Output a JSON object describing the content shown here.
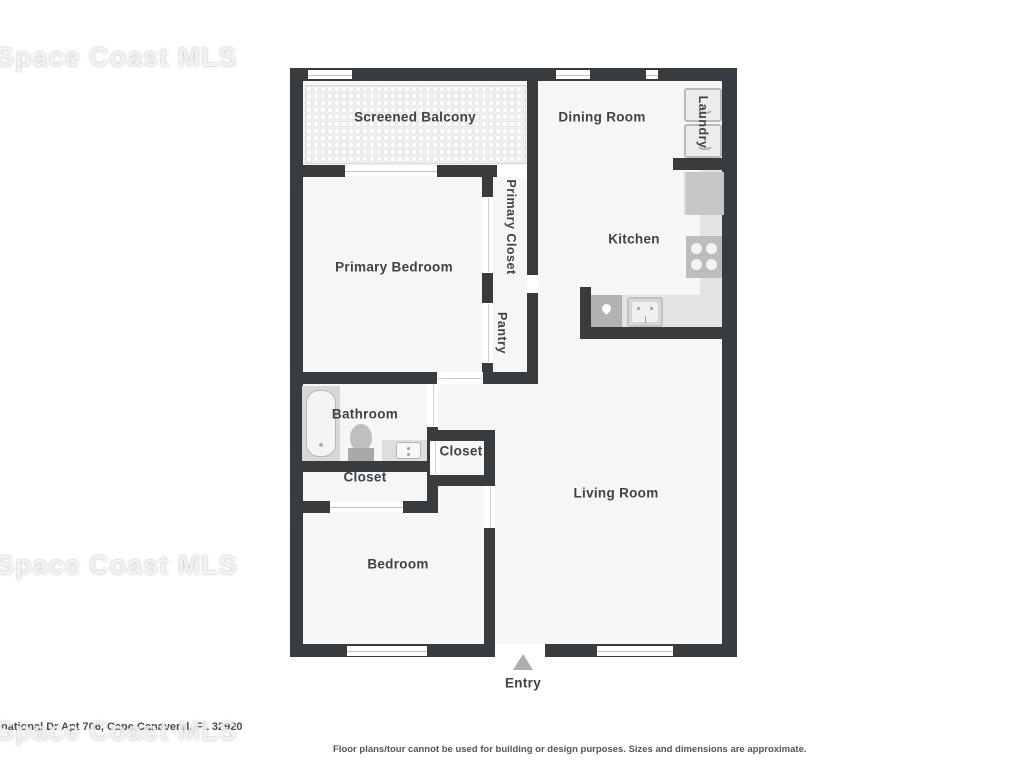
{
  "watermark": {
    "text": "Space Coast MLS"
  },
  "footer": {
    "address": "national Dr Apt 706, Cape Canaveral, FL 32920",
    "disclaimer": "Floor plans/tour cannot be used for building or design purposes. Sizes and dimensions are approximate."
  },
  "floor_plan": {
    "labels": {
      "screened_balcony": "Screened Balcony",
      "dining_room": "Dining Room",
      "laundry": "Laundry",
      "primary_closet": "Primary Closet",
      "primary_bedroom": "Primary Bedroom",
      "kitchen": "Kitchen",
      "pantry": "Pantry",
      "bathroom": "Bathroom",
      "closet_hall": "Closet",
      "closet_bedroom": "Closet",
      "living_room": "Living Room",
      "bedroom": "Bedroom",
      "entry": "Entry"
    },
    "colors": {
      "wall": "#383c3f",
      "floor": "#f6f6f6",
      "counter": "#e3e3e3",
      "appliance": "#ececec",
      "fixture_dark": "#b2b2b2",
      "fixture_mid": "#c6c6c6",
      "window_line": "#c4c4c4",
      "label_text": "#3e4347",
      "entry_arrow": "#aeaeae",
      "watermark_ghost": "#dcdcdc"
    }
  }
}
